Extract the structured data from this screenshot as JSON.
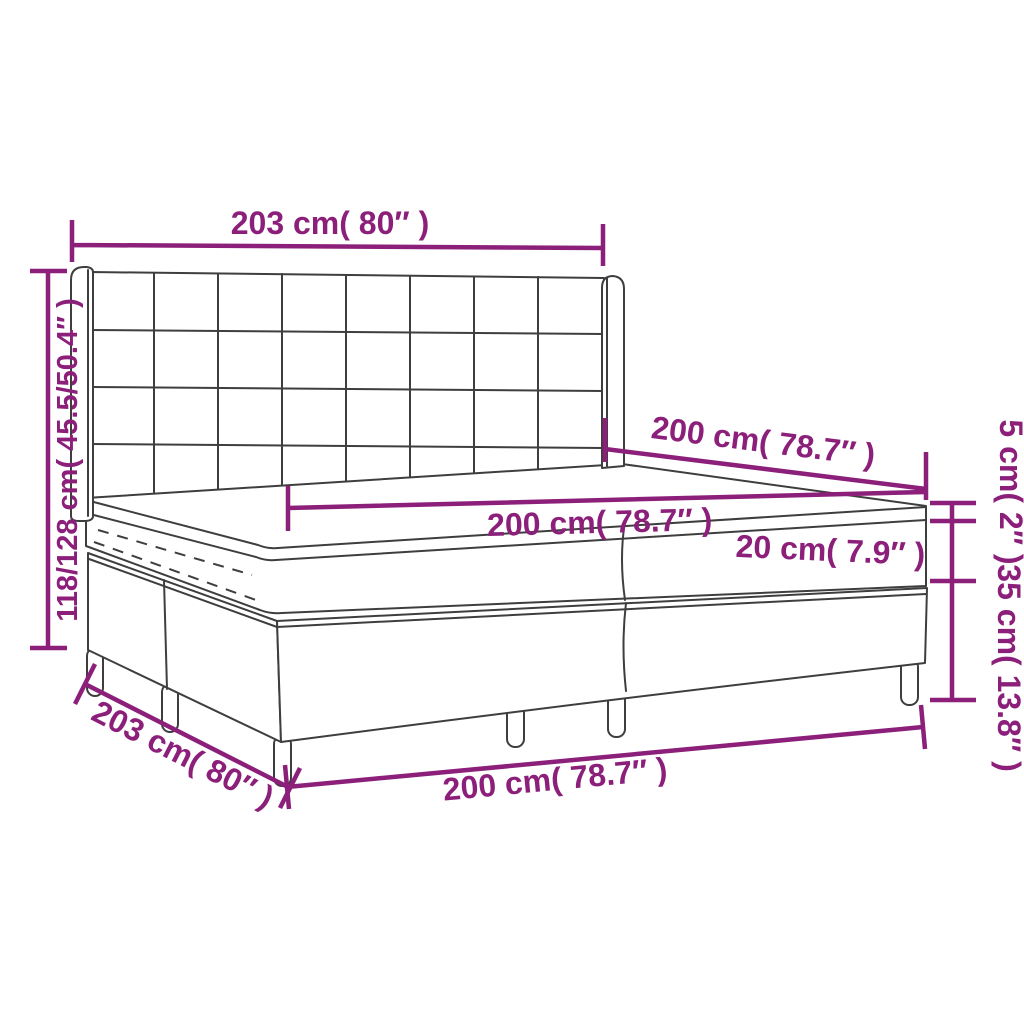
{
  "diagram": {
    "product": "box-spring-bed-with-headboard-and-topper",
    "colors": {
      "dimension_accent": "#8B1F7A",
      "line_art": "#3E3E3E",
      "background": "#FFFFFF"
    },
    "labels": {
      "headboard_width": "203 cm( 80″ )",
      "bed_height": "118/128 cm( 45.5/50.4″ )",
      "mattress_depth": "200 cm( 78.7″ )",
      "mattress_width": "200 cm( 78.7″ )",
      "mattress_height": "20 cm( 7.9″ )",
      "topper_height": "5 cm( 2″ )",
      "base_height_with_legs": "35 cm( 13.8″ )",
      "base_depth": "203 cm( 80″ )",
      "base_width": "200 cm( 78.7″ )"
    }
  }
}
